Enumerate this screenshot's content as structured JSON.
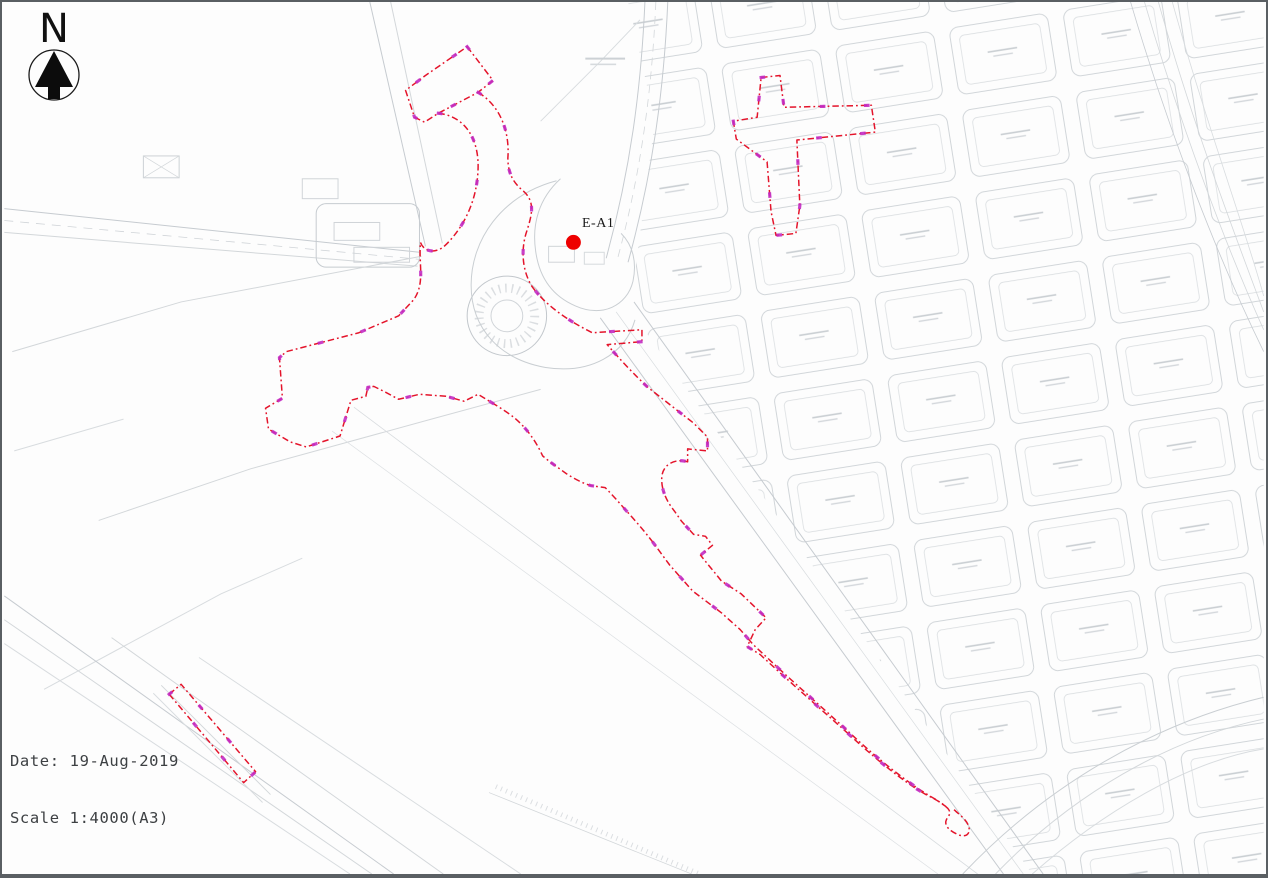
{
  "page": {
    "kind": "site-location-plan",
    "description": "CAD site plan with red dash-dot boundary lines over faint grey survey linework"
  },
  "north_indicator": {
    "label": "N"
  },
  "site_marker": {
    "label": "E-A1"
  },
  "title_block": {
    "date_label": "Date:",
    "date_value": "19-Aug-2019",
    "scale_label": "Scale",
    "scale_value": "1:4000(A3)"
  },
  "colors": {
    "boundary_red": "#E4142B",
    "vertex_magenta": "#C32CC3",
    "site_marker_red": "#EE0000",
    "linework_grey": "#C6CBD0",
    "frame_grey": "#5A5F63",
    "paper": "#FDFDFD"
  },
  "icons": {
    "north_arrow": "north-arrow-icon"
  }
}
